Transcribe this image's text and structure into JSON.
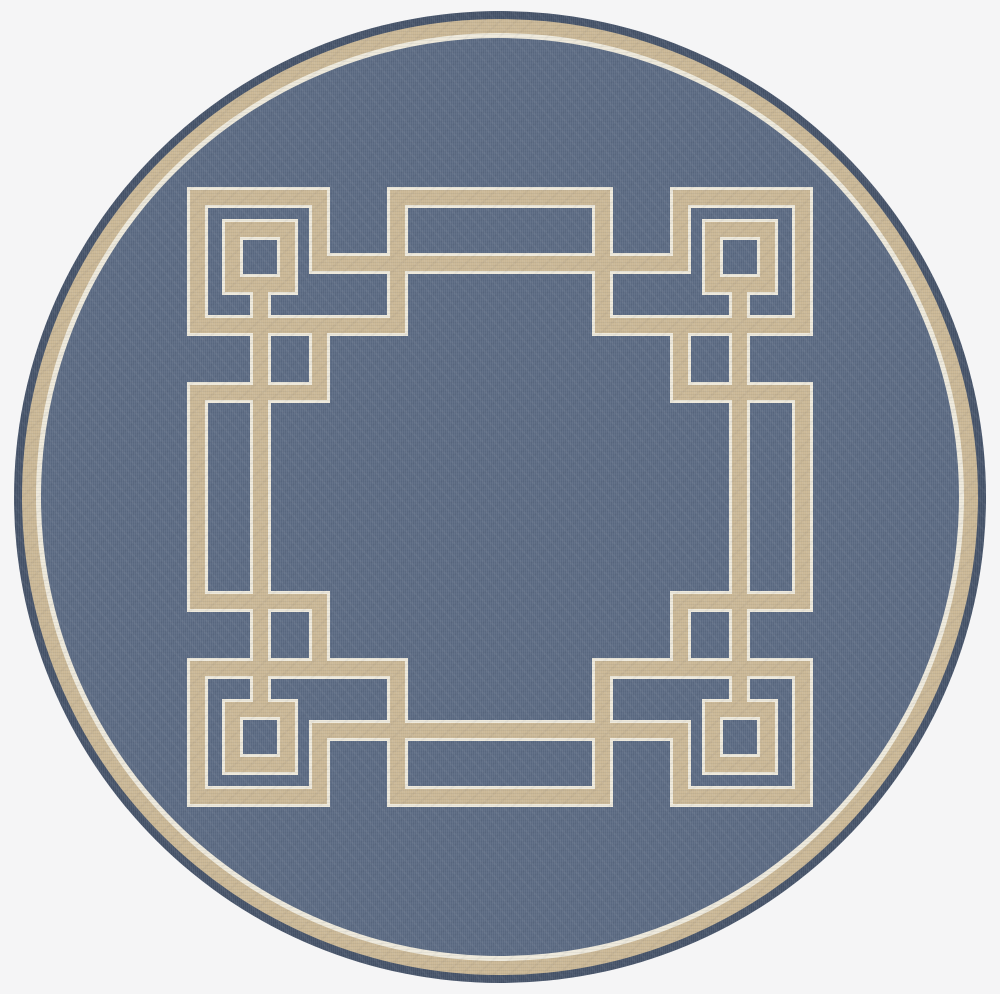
{
  "scene": {
    "type": "product-photo",
    "subject": "round-area-rug",
    "description": "Top-down photo of a round heathered navy-blue flatweave rug with a beige and cream Greek-key square fret motif in the middle and a beige ring border near the outer edge",
    "background_color": "#f5f5f6"
  },
  "rug": {
    "center_x": 500,
    "center_y": 497,
    "outer_radius": 486,
    "colors": {
      "field_blue": "#5c6b83",
      "edge_blue": "#465369",
      "tan": "#cab795",
      "cream": "#eee9db"
    },
    "rings": [
      {
        "name": "edge",
        "outer_radius": 486,
        "color": "edge_blue"
      },
      {
        "name": "tan-band",
        "outer_radius": 478,
        "color": "tan"
      },
      {
        "name": "cream-line",
        "outer_radius": 464,
        "color": "cream"
      },
      {
        "name": "field",
        "outer_radius": 459,
        "color": "field_blue"
      }
    ],
    "pattern": {
      "band_core_px": 15,
      "cream_edge_px": 3,
      "segments": [
        {
          "name": "top-line-left",
          "x": 190,
          "y": 190,
          "w": 137,
          "h": 15
        },
        {
          "name": "top-line-center",
          "x": 390,
          "y": 190,
          "w": 220,
          "h": 15
        },
        {
          "name": "top-line-right",
          "x": 673,
          "y": 190,
          "w": 137,
          "h": 15
        },
        {
          "name": "cross-line-top",
          "x": 312,
          "y": 256,
          "w": 376,
          "h": 15
        },
        {
          "name": "shelf-top-left",
          "x": 190,
          "y": 318,
          "w": 215,
          "h": 15
        },
        {
          "name": "shelf-top-right",
          "x": 595,
          "y": 318,
          "w": 215,
          "h": 15
        },
        {
          "name": "ledge-top-left",
          "x": 190,
          "y": 385,
          "w": 137,
          "h": 15
        },
        {
          "name": "ledge-top-right",
          "x": 673,
          "y": 385,
          "w": 137,
          "h": 15
        },
        {
          "name": "ledge-bottom-left",
          "x": 190,
          "y": 594,
          "w": 137,
          "h": 15
        },
        {
          "name": "ledge-bottom-right",
          "x": 673,
          "y": 594,
          "w": 137,
          "h": 15
        },
        {
          "name": "shelf-bottom-left",
          "x": 190,
          "y": 661,
          "w": 215,
          "h": 15
        },
        {
          "name": "shelf-bottom-right",
          "x": 595,
          "y": 661,
          "w": 215,
          "h": 15
        },
        {
          "name": "cross-line-bottom",
          "x": 312,
          "y": 723,
          "w": 376,
          "h": 15
        },
        {
          "name": "bottom-line-left",
          "x": 190,
          "y": 789,
          "w": 137,
          "h": 15
        },
        {
          "name": "bottom-line-center",
          "x": 390,
          "y": 789,
          "w": 220,
          "h": 15
        },
        {
          "name": "bottom-line-right",
          "x": 673,
          "y": 789,
          "w": 137,
          "h": 15
        },
        {
          "name": "outer-left-upper",
          "x": 190,
          "y": 190,
          "w": 15,
          "h": 143
        },
        {
          "name": "outer-left-middle",
          "x": 190,
          "y": 385,
          "w": 15,
          "h": 224
        },
        {
          "name": "outer-left-lower",
          "x": 190,
          "y": 661,
          "w": 15,
          "h": 143
        },
        {
          "name": "outer-right-upper",
          "x": 795,
          "y": 190,
          "w": 15,
          "h": 143
        },
        {
          "name": "outer-right-middle",
          "x": 795,
          "y": 385,
          "w": 15,
          "h": 224
        },
        {
          "name": "outer-right-lower",
          "x": 795,
          "y": 661,
          "w": 15,
          "h": 143
        },
        {
          "name": "notch-left-top",
          "x": 312,
          "y": 190,
          "w": 15,
          "h": 81
        },
        {
          "name": "notch-right-top",
          "x": 673,
          "y": 190,
          "w": 15,
          "h": 81
        },
        {
          "name": "notch-left-bottom",
          "x": 312,
          "y": 723,
          "w": 15,
          "h": 81
        },
        {
          "name": "notch-right-bottom",
          "x": 673,
          "y": 723,
          "w": 15,
          "h": 81
        },
        {
          "name": "drop-left-top",
          "x": 390,
          "y": 190,
          "w": 15,
          "h": 143
        },
        {
          "name": "drop-right-top",
          "x": 595,
          "y": 190,
          "w": 15,
          "h": 143
        },
        {
          "name": "drop-left-bottom",
          "x": 390,
          "y": 661,
          "w": 15,
          "h": 143
        },
        {
          "name": "drop-right-bottom",
          "x": 595,
          "y": 661,
          "w": 15,
          "h": 143
        },
        {
          "name": "step-left-top",
          "x": 312,
          "y": 318,
          "w": 15,
          "h": 82
        },
        {
          "name": "step-right-top",
          "x": 673,
          "y": 318,
          "w": 15,
          "h": 82
        },
        {
          "name": "step-left-bottom",
          "x": 312,
          "y": 594,
          "w": 15,
          "h": 82
        },
        {
          "name": "step-right-bottom",
          "x": 673,
          "y": 594,
          "w": 15,
          "h": 82
        },
        {
          "name": "spine-left",
          "x": 253,
          "y": 292,
          "w": 15,
          "h": 410
        },
        {
          "name": "spine-right",
          "x": 732,
          "y": 292,
          "w": 15,
          "h": 410
        },
        {
          "name": "square-tl-top",
          "x": 225,
          "y": 222,
          "w": 70,
          "h": 15
        },
        {
          "name": "square-tl-bottom",
          "x": 225,
          "y": 277,
          "w": 70,
          "h": 15
        },
        {
          "name": "square-tl-left",
          "x": 225,
          "y": 222,
          "w": 15,
          "h": 70
        },
        {
          "name": "square-tl-right",
          "x": 280,
          "y": 222,
          "w": 15,
          "h": 70
        },
        {
          "name": "square-tr-top",
          "x": 705,
          "y": 222,
          "w": 70,
          "h": 15
        },
        {
          "name": "square-tr-bottom",
          "x": 705,
          "y": 277,
          "w": 70,
          "h": 15
        },
        {
          "name": "square-tr-left",
          "x": 705,
          "y": 222,
          "w": 15,
          "h": 70
        },
        {
          "name": "square-tr-right",
          "x": 760,
          "y": 222,
          "w": 15,
          "h": 70
        },
        {
          "name": "square-bl-top",
          "x": 225,
          "y": 702,
          "w": 70,
          "h": 15
        },
        {
          "name": "square-bl-bottom",
          "x": 225,
          "y": 757,
          "w": 70,
          "h": 15
        },
        {
          "name": "square-bl-left",
          "x": 225,
          "y": 702,
          "w": 15,
          "h": 70
        },
        {
          "name": "square-bl-right",
          "x": 280,
          "y": 702,
          "w": 15,
          "h": 70
        },
        {
          "name": "square-br-top",
          "x": 705,
          "y": 702,
          "w": 70,
          "h": 15
        },
        {
          "name": "square-br-bottom",
          "x": 705,
          "y": 757,
          "w": 70,
          "h": 15
        },
        {
          "name": "square-br-left",
          "x": 705,
          "y": 702,
          "w": 15,
          "h": 70
        },
        {
          "name": "square-br-right",
          "x": 760,
          "y": 702,
          "w": 15,
          "h": 70
        }
      ]
    }
  }
}
